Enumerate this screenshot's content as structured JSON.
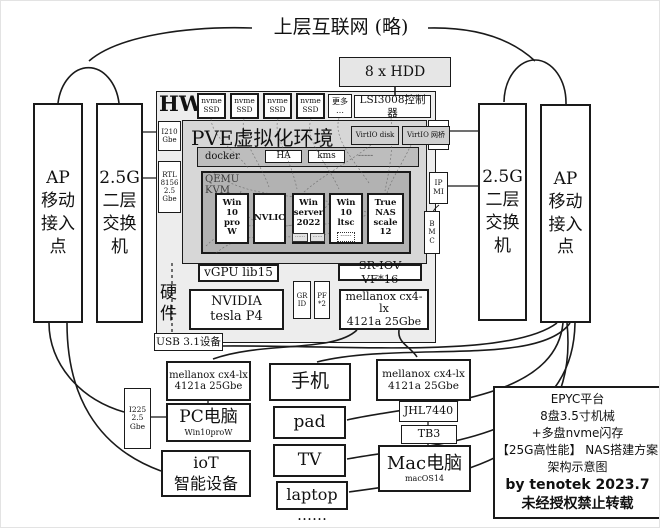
{
  "colors": {
    "line": "#1a1a1a",
    "hw_bg": "#ededed",
    "pve_bg": "#d7d7d7",
    "docker_bg": "#bdbdbd",
    "qemu_bg": "#b2b2b2",
    "hdd_bg": "#e6e6e6"
  },
  "top": {
    "internet": "上层互联网 (略)",
    "hdd": "8 x HDD"
  },
  "left": {
    "ap": "AP\n移动\n接入\n点",
    "switch": "2.5G\n二层\n交换\n机"
  },
  "right": {
    "switch": "2.5G\n二层\n交换\n机",
    "ap": "AP\n移动\n接入\n点"
  },
  "hw": {
    "label": "HW",
    "nvme": "nvme\nSSD",
    "more": "更多\n…",
    "lsi": "LSI3008控制器",
    "nic_left": {
      "i210": "I210\nGbe",
      "rtl": "RTL\n8156\n2.5\nGbe"
    },
    "nic_right": {
      "i210": "I210\nGbe",
      "ipmi": "IP\nMI",
      "bmc": "B\nM\nC"
    },
    "hardware_label": "硬\n件",
    "usb": "USB 3.1设备",
    "vgpu": "vGPU lib15",
    "sriov": "SR-IOV VF*16",
    "grid": "GR\nID",
    "pf": "PF\n*2",
    "nvidia": "NVIDIA\ntesla P4",
    "mellanox": "mellanox cx4-lx\n4121a 25Gbe"
  },
  "pve": {
    "title": "PVE虚拟化环境",
    "virtio_disk": "VirtIO disk",
    "virtio_net": "VirtIO 网桥",
    "docker": "docker",
    "ha": "HA",
    "kms": "kms",
    "docker_more": "-----",
    "qemu": "QEMU\nKVM",
    "vms": [
      {
        "label": "Win\n10\npro\nW"
      },
      {
        "label": "NVLIC"
      },
      {
        "label": "Win\nserver\n2022",
        "sub1": "⋯⋯",
        "sub2": "⋯⋯"
      },
      {
        "label": "Win\n10\nltsc",
        "sub": "······"
      },
      {
        "label": "True\nNAS\nscale\n12"
      }
    ]
  },
  "bottom": {
    "i225": "I225\n2.5\nGbe",
    "mellanox_pc": "mellanox cx4-lx\n4121a 25Gbe",
    "pc": "PC电脑",
    "pc_os": "Win10proW",
    "iot": "ioT\n智能设备",
    "devices": [
      {
        "label": "手机"
      },
      {
        "label": "pad"
      },
      {
        "label": "TV"
      },
      {
        "label": "laptop"
      }
    ],
    "devices_more": "……",
    "mellanox_mac": "mellanox cx4-lx\n4121a 25Gbe",
    "jhl": "JHL7440",
    "tb3": "TB3",
    "mac": "Mac电脑",
    "mac_os": "macOS14"
  },
  "legend": {
    "lines": [
      "EPYC平台",
      "8盘3.5寸机械",
      "+多盘nvme闪存",
      "【25G高性能】 NAS搭建方案",
      "架构示意图"
    ],
    "byline": "by tenotek  2023.7",
    "notice": "未经授权禁止转载"
  }
}
